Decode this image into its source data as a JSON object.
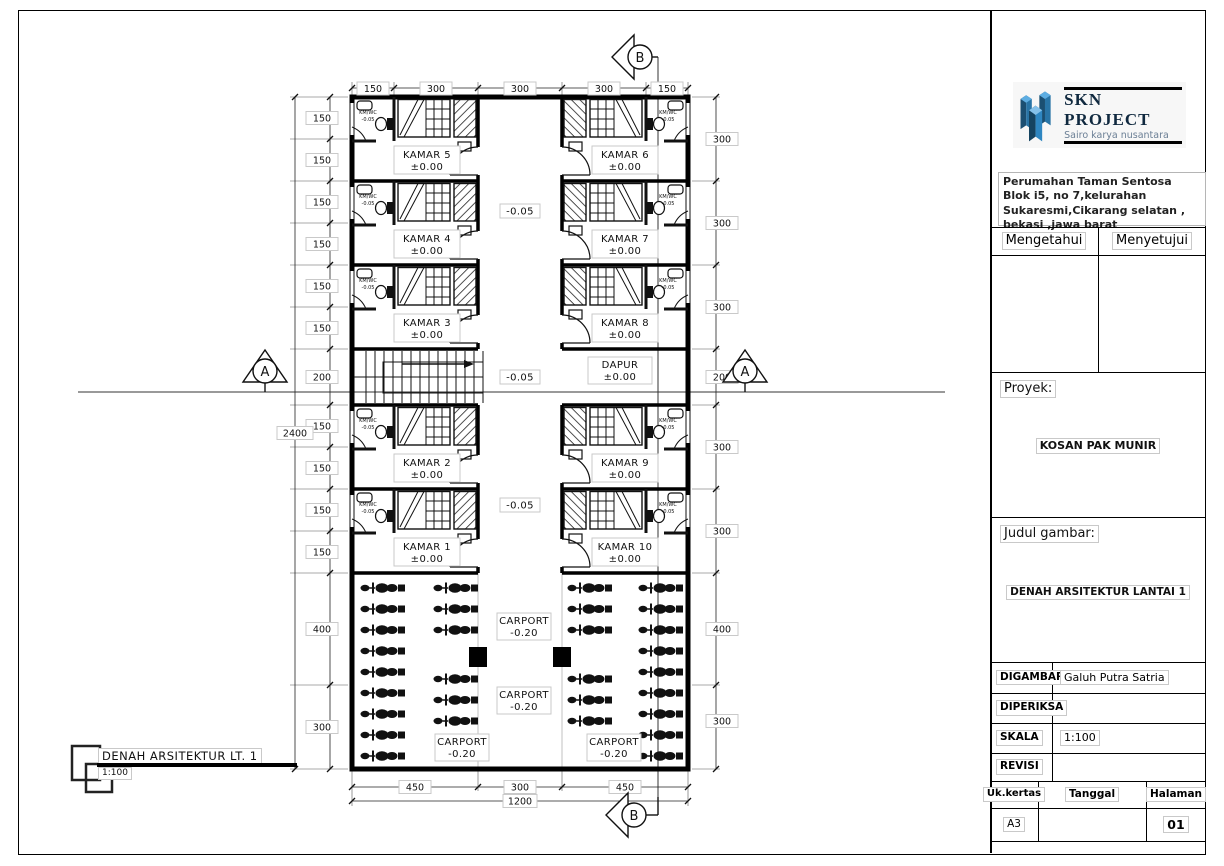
{
  "logo": {
    "title": "SKN PROJECT",
    "subtitle": "Sairo karya nusantara",
    "color_dark": "#1b4f72",
    "color_mid": "#2874a6"
  },
  "titleblock": {
    "address": "Perumahan Taman Sentosa Blok i5, no 7,kelurahan Sukaresmi,Cikarang selatan , bekasi ,jawa barat",
    "approve_left": "Mengetahui",
    "approve_right": "Menyetujui",
    "project_label": "Proyek:",
    "project_value": "KOSAN PAK MUNIR",
    "title_label": "Judul gambar:",
    "title_value": "DENAH ARSITEKTUR LANTAI 1",
    "drawn_label": "DIGAMBAR",
    "drawn_value": "Galuh Putra Satria",
    "checked_label": "DIPERIKSA",
    "checked_value": "",
    "scale_label": "SKALA",
    "scale_value": "1:100",
    "revision_label": "REVISI",
    "revision_value": "",
    "paper_label": "Uk.kertas",
    "date_label": "Tanggal",
    "page_label": "Halaman",
    "paper_value": "A3",
    "date_value": "",
    "page_value": "01"
  },
  "footer": {
    "title": "DENAH ARSITEKTUR LT. 1",
    "scale": "1:100"
  },
  "plan": {
    "rooms_left": [
      {
        "name": "KAMAR 5",
        "level": "±0.00"
      },
      {
        "name": "KAMAR 4",
        "level": "±0.00"
      },
      {
        "name": "KAMAR 3",
        "level": "±0.00"
      },
      {
        "name": "KAMAR 2",
        "level": "±0.00"
      },
      {
        "name": "KAMAR 1",
        "level": "±0.00"
      }
    ],
    "rooms_right": [
      {
        "name": "KAMAR 6",
        "level": "±0.00"
      },
      {
        "name": "KAMAR 7",
        "level": "±0.00"
      },
      {
        "name": "KAMAR 8",
        "level": "±0.00"
      },
      {
        "name": "KAMAR 9",
        "level": "±0.00"
      },
      {
        "name": "KAMAR 10",
        "level": "±0.00"
      }
    ],
    "kitchen": {
      "name": "DAPUR",
      "level": "±0.00"
    },
    "bath": {
      "name": "KM/WC",
      "level": "-0.05"
    },
    "corridor_level": "-0.05",
    "carport": {
      "name": "CARPORT",
      "level": "-0.20"
    },
    "section_a": "A",
    "section_b": "B",
    "dims": {
      "top": [
        "150",
        "300",
        "300",
        "300",
        "150"
      ],
      "bottom": [
        "450",
        "300",
        "450"
      ],
      "bottom_total": "1200",
      "left": [
        "150",
        "150",
        "150",
        "150",
        "150",
        "150",
        "200",
        "150",
        "150",
        "150",
        "150",
        "400",
        "300"
      ],
      "left_total": "2400",
      "right": [
        "300",
        "300",
        "300",
        "200",
        "300",
        "300",
        "400",
        "300"
      ]
    }
  }
}
